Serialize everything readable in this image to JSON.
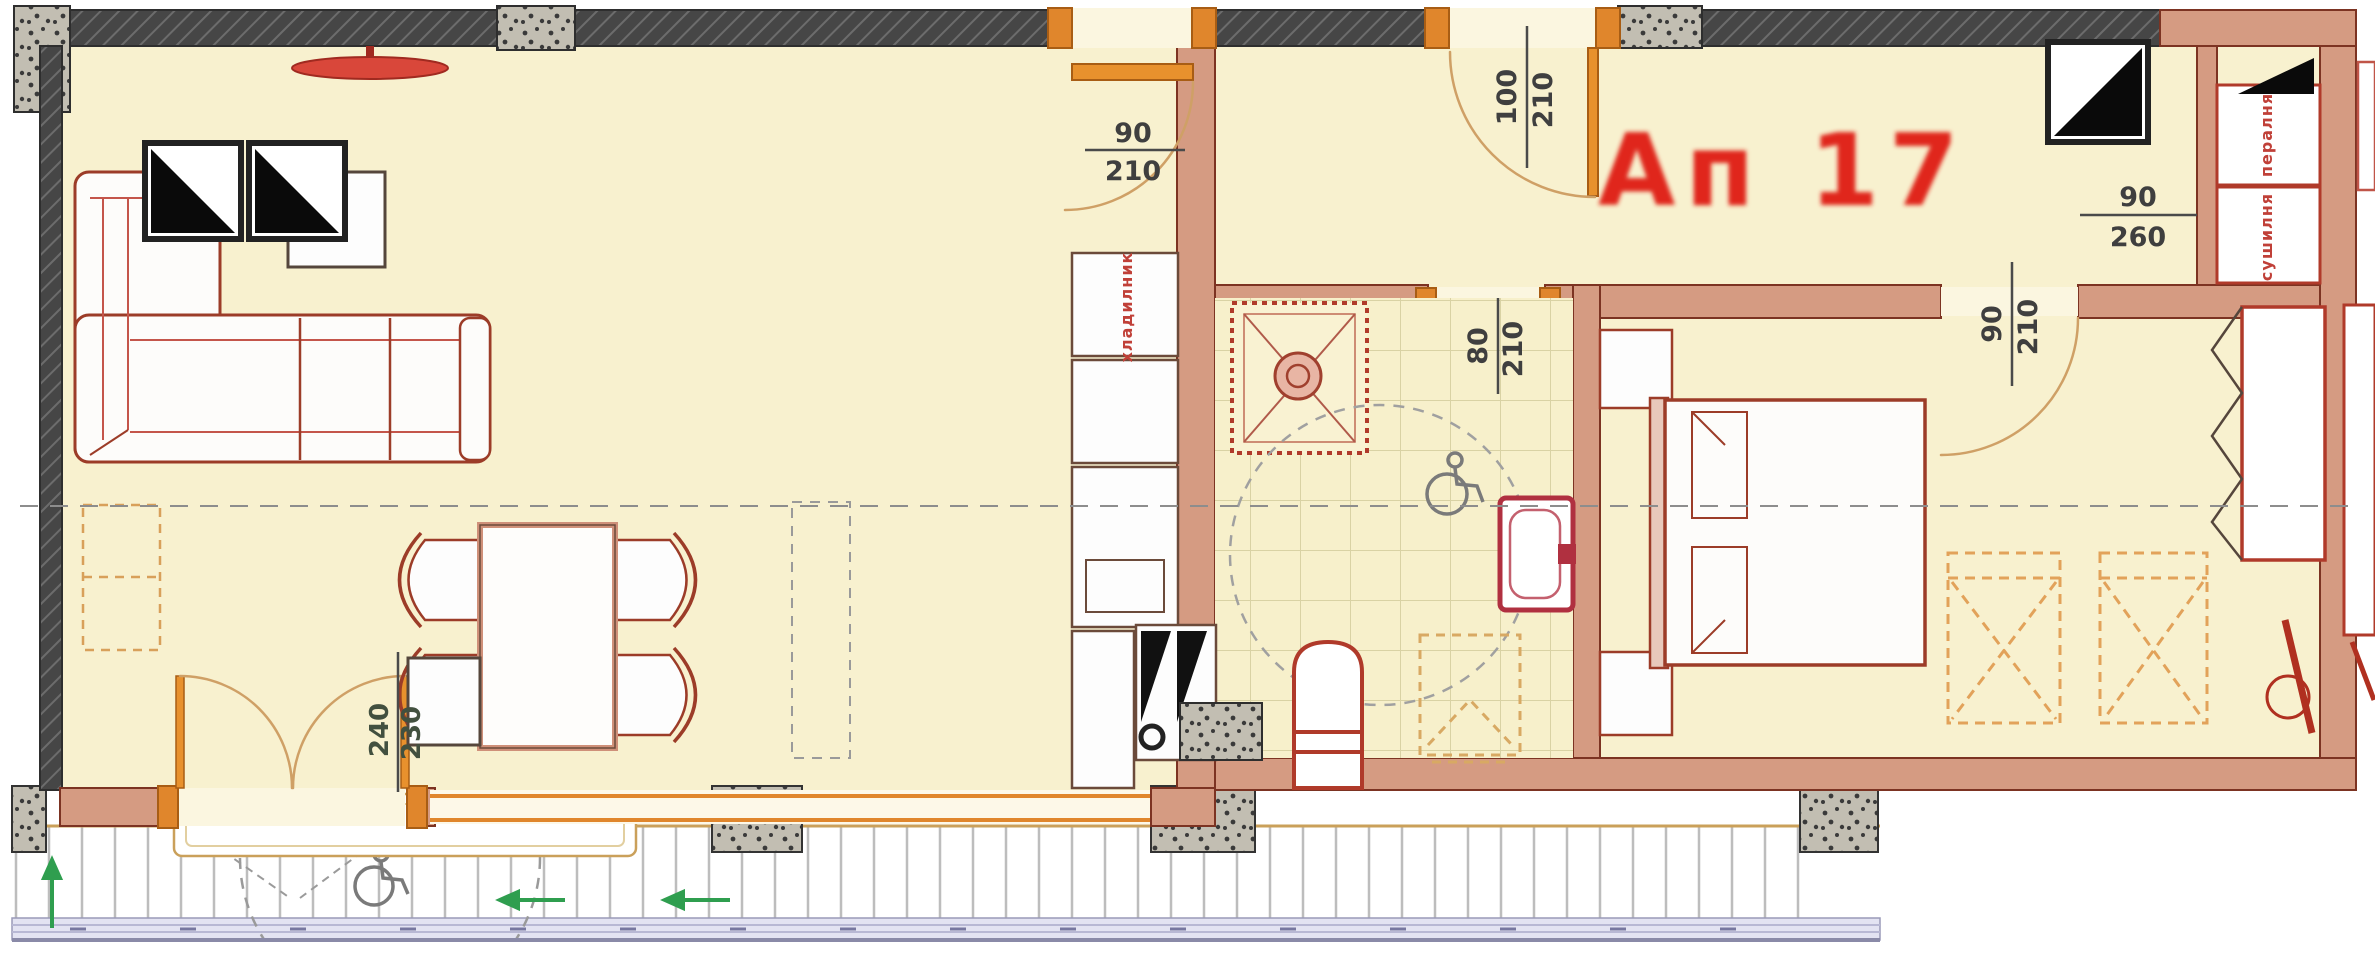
{
  "plan": {
    "apartment_label": "Ап 17",
    "dimensions": {
      "living_door": {
        "width": "90",
        "height": "210"
      },
      "entrance_door": {
        "width": "100",
        "height": "210"
      },
      "bathroom_door": {
        "width": "80",
        "height": "210"
      },
      "bedroom_door": {
        "width": "90",
        "height": "210"
      },
      "laundry_opening": {
        "width": "90",
        "height": "260"
      },
      "balcony_door": {
        "width": "240",
        "height": "230"
      }
    },
    "appliance_labels": {
      "washer": "пералня",
      "dryer": "сушилня",
      "fridge": "хладилник"
    },
    "colors": {
      "wall_fill": "#d59b82",
      "floor_fill": "#f8f1cf",
      "label_red": "#e0281a",
      "furniture_outline": "#9c3c28",
      "door_frame_orange": "#e0862c",
      "arrow_green": "#2f9e4f"
    }
  }
}
